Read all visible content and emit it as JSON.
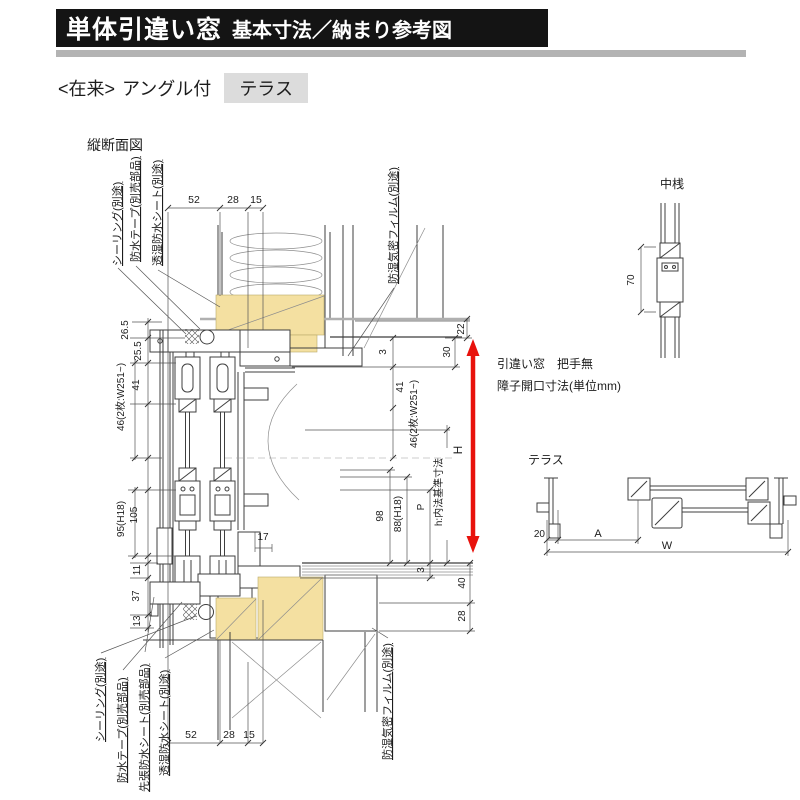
{
  "header": {
    "title_main": "単体引違い窓",
    "title_sub": "基本寸法／納まり参考図",
    "variant_prefix": "<在来>",
    "variant_middle": "アングル付",
    "variant_tag": "テラス"
  },
  "vertical_section": {
    "caption": "縦断面図",
    "top_dims": [
      "52",
      "28",
      "15"
    ],
    "bottom_dims": [
      "52",
      "28",
      "15"
    ],
    "left_labels": [
      "26.5",
      "25.5",
      "41",
      "46(2枚:W251~)",
      "95(H18)",
      "105",
      "11",
      "37",
      "13"
    ],
    "right_labels": [
      "3",
      "41",
      "46(2枚:W251~)",
      "98",
      "88(H18)",
      "P",
      "h:内法基準寸法",
      "30",
      "22",
      "H",
      "3",
      "40",
      "28",
      "17"
    ],
    "top_callouts": [
      "シーリング(別途)",
      "防水テープ(別売部品)",
      "透湿防水シート(別途)",
      "防湿気密フィルム(別途)"
    ],
    "bottom_callouts": [
      "シーリング(別途)",
      "防水テープ(別売部品)",
      "先張防水シート(別売部品)",
      "透湿防水シート(別途)",
      "防湿気密フィルム(別途)"
    ]
  },
  "center_rail_detail": {
    "title": "中桟",
    "dim": "70"
  },
  "note": {
    "line1": "引違い窓　把手無",
    "line2": "障子開口寸法(単位mm)"
  },
  "horizontal_section": {
    "title": "テラス",
    "dims": [
      "20",
      "A",
      "W"
    ]
  },
  "colors": {
    "accent_red": "#e8120c",
    "wood": "#f4e0a1",
    "tag_bg": "#dcdcdc",
    "title_bg": "#141414",
    "rule_gray": "#b3b3b3"
  }
}
